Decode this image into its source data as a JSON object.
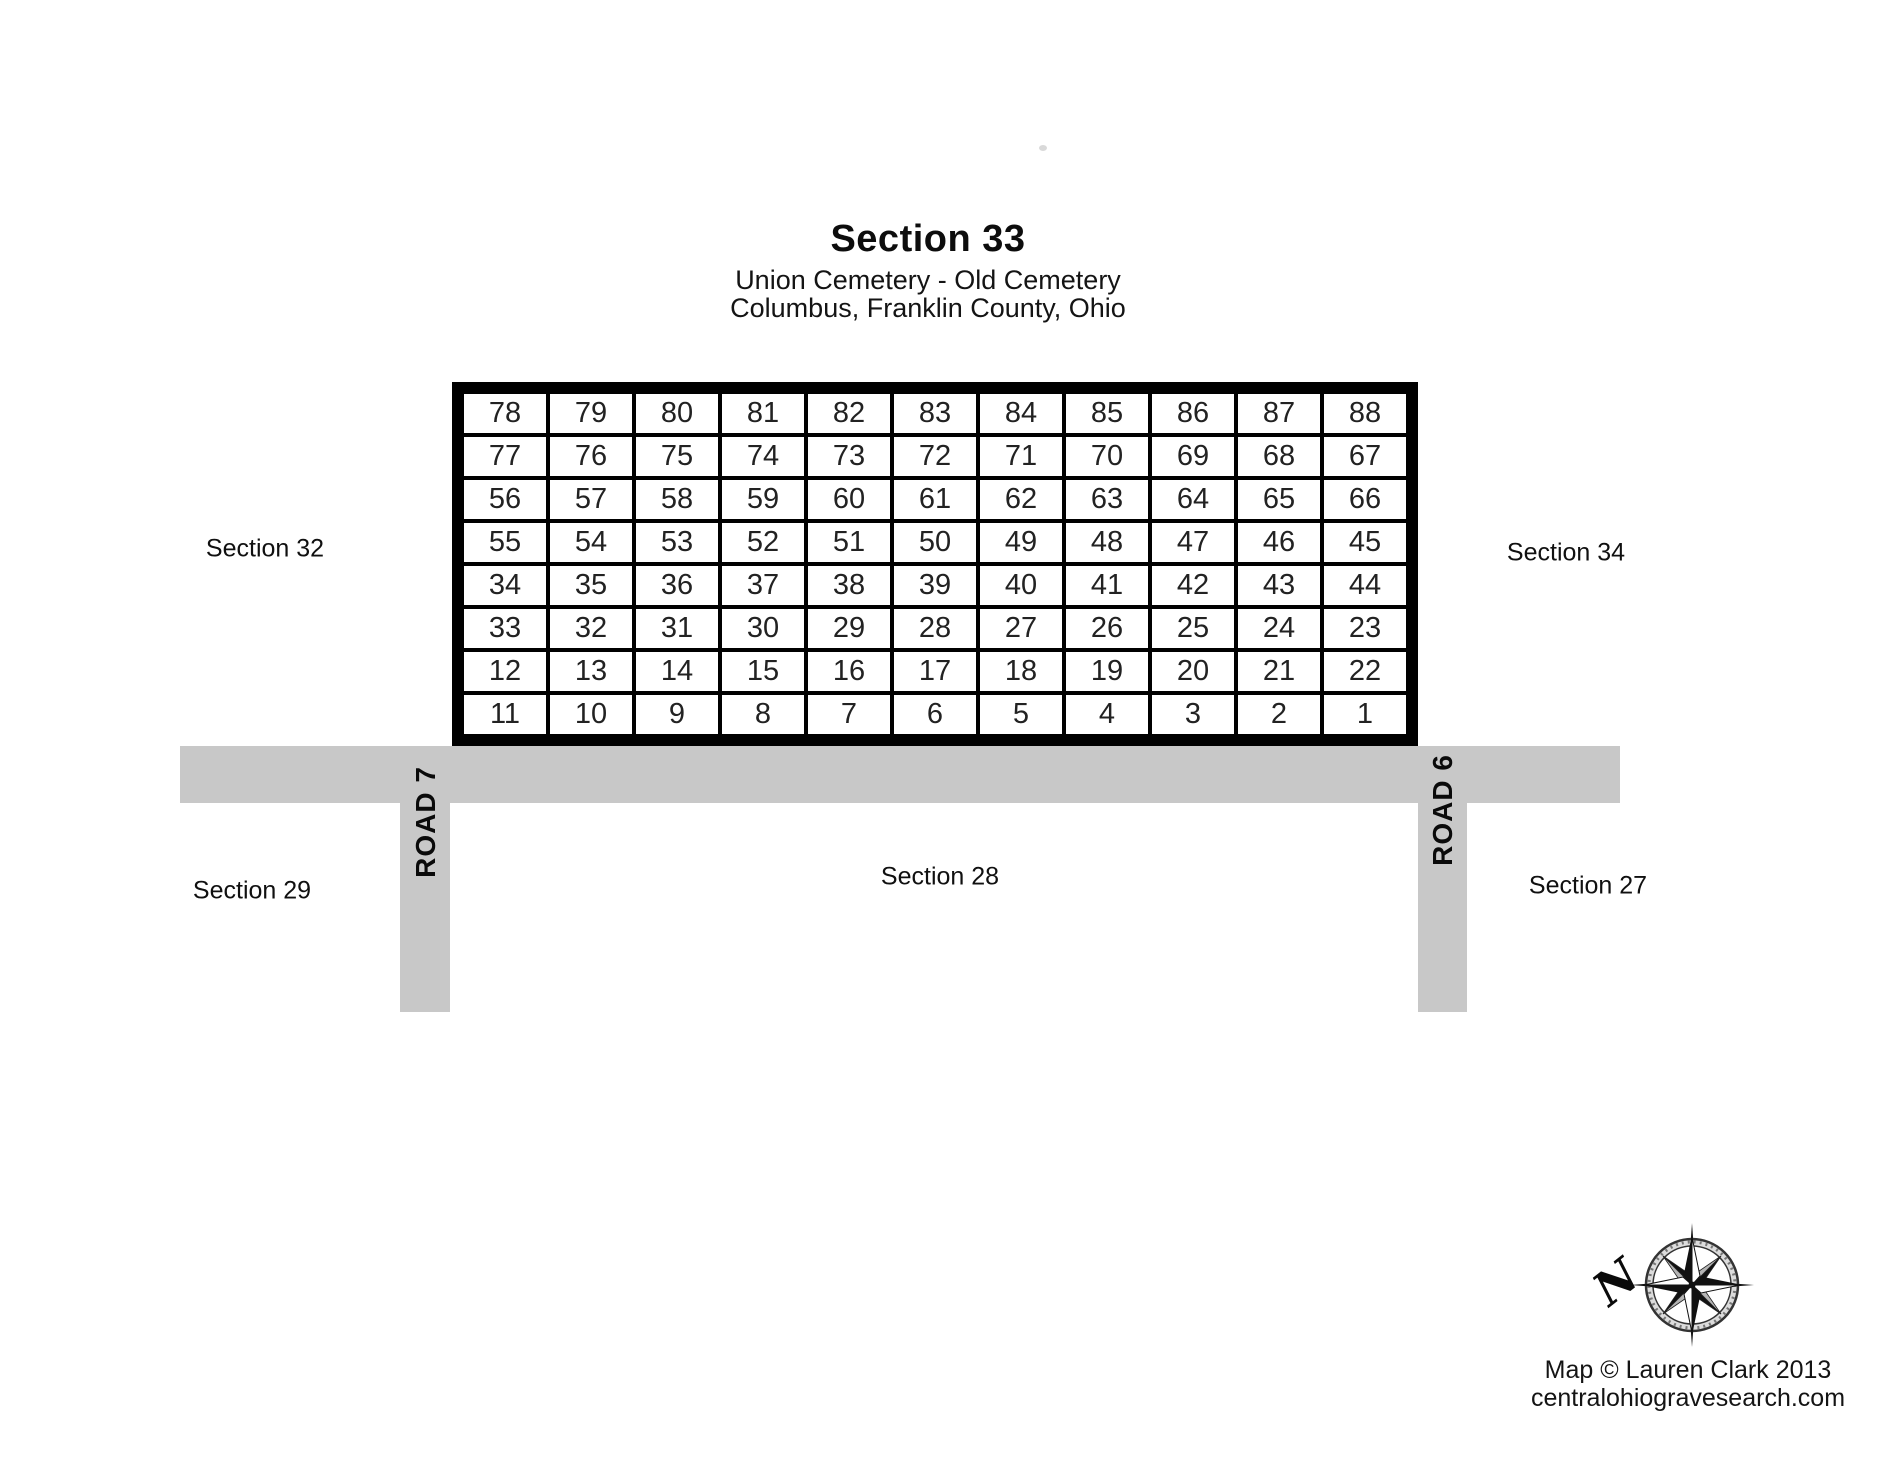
{
  "header": {
    "title": "Section 33",
    "subtitle_line1": "Union Cemetery - Old Cemetery",
    "subtitle_line2": "Columbus, Franklin County, Ohio"
  },
  "lot_grid": {
    "rows": [
      [
        "78",
        "79",
        "80",
        "81",
        "82",
        "83",
        "84",
        "85",
        "86",
        "87",
        "88"
      ],
      [
        "77",
        "76",
        "75",
        "74",
        "73",
        "72",
        "71",
        "70",
        "69",
        "68",
        "67"
      ],
      [
        "56",
        "57",
        "58",
        "59",
        "60",
        "61",
        "62",
        "63",
        "64",
        "65",
        "66"
      ],
      [
        "55",
        "54",
        "53",
        "52",
        "51",
        "50",
        "49",
        "48",
        "47",
        "46",
        "45"
      ],
      [
        "34",
        "35",
        "36",
        "37",
        "38",
        "39",
        "40",
        "41",
        "42",
        "43",
        "44"
      ],
      [
        "33",
        "32",
        "31",
        "30",
        "29",
        "28",
        "27",
        "26",
        "25",
        "24",
        "23"
      ],
      [
        "12",
        "13",
        "14",
        "15",
        "16",
        "17",
        "18",
        "19",
        "20",
        "21",
        "22"
      ],
      [
        "11",
        "10",
        "9",
        "8",
        "7",
        "6",
        "5",
        "4",
        "3",
        "2",
        "1"
      ]
    ]
  },
  "roads": {
    "road7_label": "ROAD 7",
    "road6_label": "ROAD 6",
    "road_color": "#c8c8c8"
  },
  "adjacent_sections": {
    "west": "Section 32",
    "east": "Section 34",
    "southwest": "Section 29",
    "south": "Section 28",
    "southeast": "Section 27"
  },
  "compass": {
    "north_label": "N"
  },
  "credits": {
    "line1": "Map © Lauren Clark 2013",
    "line2": "centralohiogravesearch.com"
  }
}
